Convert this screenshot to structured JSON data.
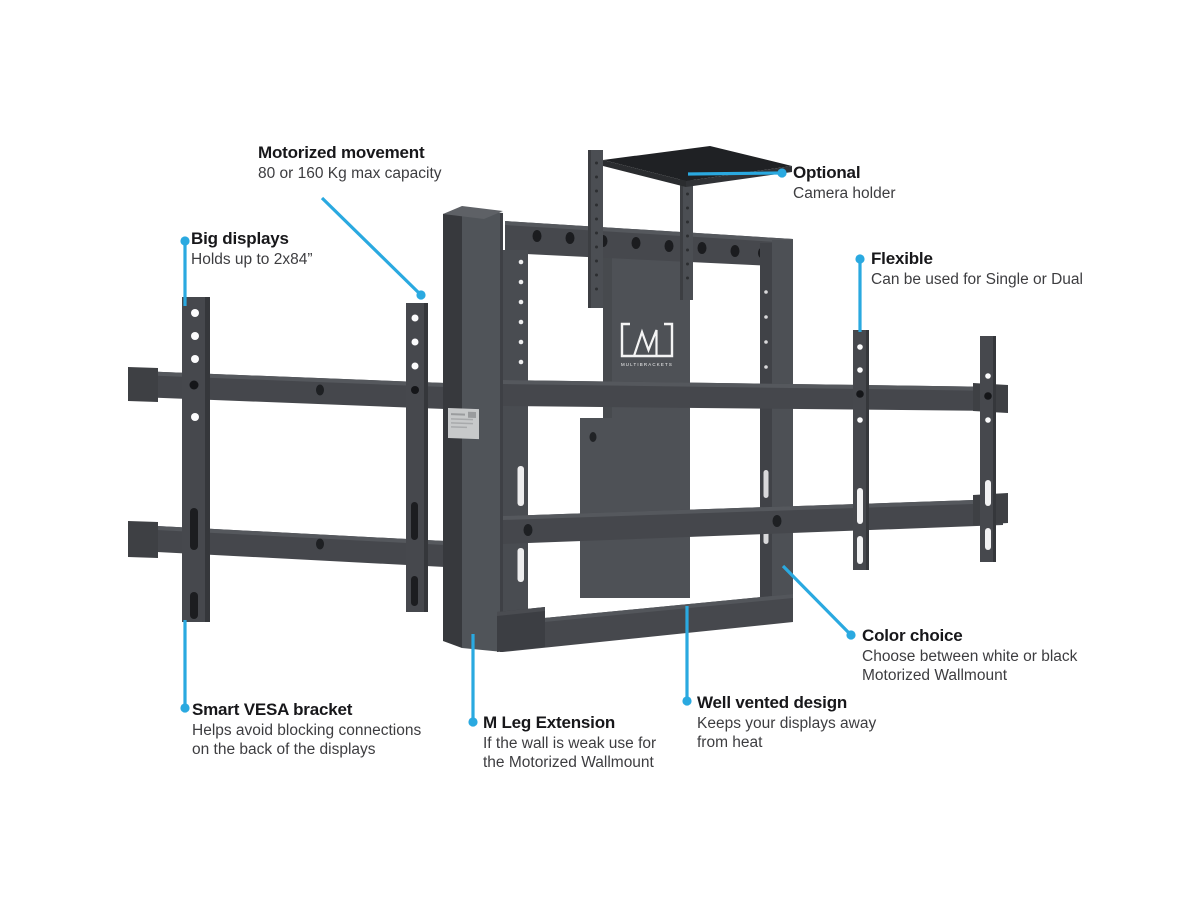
{
  "page": {
    "background": "#ffffff"
  },
  "accent_color": "#2aa9e0",
  "brand": {
    "logo_text": "MULTIBRACKETS"
  },
  "product_colors": {
    "frame": "#46484d",
    "column_front": "#505459",
    "column_side": "#37393d",
    "highlight": "#5e6166",
    "platform_top": "#1f2124",
    "ce_label": "#c7c9ca"
  },
  "callouts": [
    {
      "title": "Motorized movement",
      "lines": [
        "80 or 160 Kg max capacity"
      ]
    },
    {
      "title": "Big displays",
      "lines": [
        "Holds up to 2x84”"
      ]
    },
    {
      "title": "Optional",
      "lines": [
        "Camera holder"
      ]
    },
    {
      "title": "Flexible",
      "lines": [
        "Can be used for Single or Dual"
      ]
    },
    {
      "title": "Color choice",
      "lines": [
        "Choose between white or black",
        "Motorized Wallmount"
      ]
    },
    {
      "title": "Smart VESA bracket",
      "lines": [
        "Helps avoid blocking connections",
        "on the back of the displays"
      ]
    },
    {
      "title": "M Leg Extension",
      "lines": [
        "If the wall is weak use for",
        "the Motorized Wallmount"
      ]
    },
    {
      "title": "Well vented design",
      "lines": [
        "Keeps your displays away",
        "from heat"
      ]
    }
  ]
}
